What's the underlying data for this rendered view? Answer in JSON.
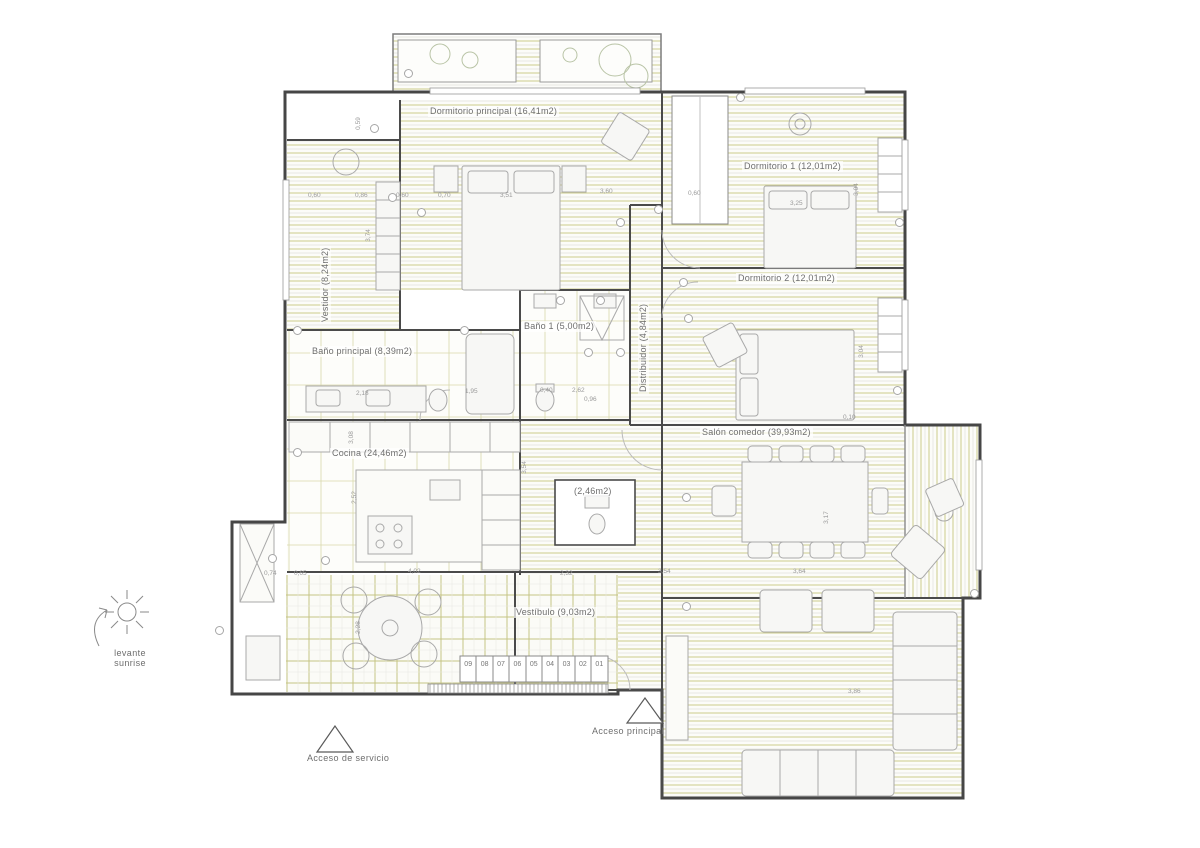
{
  "colors": {
    "hatch_olive": "#cdcc8b",
    "hatch_gray": "#e9e9e4",
    "tile_grid": "#c6c584",
    "wall": "#4a4a4a",
    "furniture": "#a9a9a9",
    "label_text": "#6e6e6e"
  },
  "rooms": {
    "dormitorio_principal": {
      "label": "Dormitorio principal (16,41m2)"
    },
    "dormitorio_1": {
      "label": "Dormitorio 1 (12,01m2)"
    },
    "dormitorio_2": {
      "label": "Dormitorio 2 (12,01m2)"
    },
    "vestidor": {
      "label": "Vestidor (8,24m2)"
    },
    "bano_principal": {
      "label": "Baño principal (8,39m2)"
    },
    "bano_1": {
      "label": "Baño 1 (5,00m2)"
    },
    "distribuidor": {
      "label": "Distribuidor (4,84m2)"
    },
    "cocina": {
      "label": "Cocina (24,46m2)"
    },
    "salon_comedor": {
      "label": "Salón comedor (39,93m2)"
    },
    "vestibulo": {
      "label": "Vestíbulo (9,03m2)"
    },
    "aseo": {
      "label": "(2,46m2)"
    }
  },
  "annotations": {
    "sun_line1": "levante",
    "sun_line2": "sunrise",
    "acceso_servicio": "Acceso de servicio",
    "acceso_principal": "Acceso principal"
  },
  "stairs": {
    "treads": [
      "09",
      "08",
      "07",
      "06",
      "05",
      "04",
      "03",
      "02",
      "01"
    ]
  },
  "dimensions": [
    {
      "text": "0,60",
      "x": 308,
      "y": 192
    },
    {
      "text": "0,86",
      "x": 355,
      "y": 192
    },
    {
      "text": "0,60",
      "x": 396,
      "y": 192
    },
    {
      "text": "0,70",
      "x": 438,
      "y": 192
    },
    {
      "text": "3,51",
      "x": 500,
      "y": 192
    },
    {
      "text": "3,60",
      "x": 600,
      "y": 188
    },
    {
      "text": "0,60",
      "x": 688,
      "y": 190
    },
    {
      "text": "3,25",
      "x": 790,
      "y": 200
    },
    {
      "text": "0,59",
      "x": 352,
      "y": 120,
      "r": -90
    },
    {
      "text": "3,74",
      "x": 362,
      "y": 232,
      "r": -90
    },
    {
      "text": "3,04",
      "x": 850,
      "y": 186,
      "r": -90
    },
    {
      "text": "3,04",
      "x": 855,
      "y": 348,
      "r": -90
    },
    {
      "text": "2,18",
      "x": 356,
      "y": 390
    },
    {
      "text": "1,95",
      "x": 465,
      "y": 388
    },
    {
      "text": "0,40",
      "x": 540,
      "y": 387
    },
    {
      "text": "2,62",
      "x": 572,
      "y": 387
    },
    {
      "text": "0,96",
      "x": 584,
      "y": 396
    },
    {
      "text": "0,10",
      "x": 843,
      "y": 414
    },
    {
      "text": "3,08",
      "x": 345,
      "y": 434,
      "r": -90
    },
    {
      "text": "2,52",
      "x": 348,
      "y": 494,
      "r": -90
    },
    {
      "text": "3,54",
      "x": 518,
      "y": 464,
      "r": -90
    },
    {
      "text": "3,17",
      "x": 820,
      "y": 514,
      "r": -90
    },
    {
      "text": "2,32",
      "x": 560,
      "y": 570
    },
    {
      "text": "3,54",
      "x": 658,
      "y": 568
    },
    {
      "text": "3,64",
      "x": 793,
      "y": 568
    },
    {
      "text": "0,74",
      "x": 264,
      "y": 570
    },
    {
      "text": "0,65",
      "x": 294,
      "y": 570
    },
    {
      "text": "4,02",
      "x": 408,
      "y": 568
    },
    {
      "text": "2,28",
      "x": 352,
      "y": 624,
      "r": -90
    },
    {
      "text": "3,86",
      "x": 848,
      "y": 688
    }
  ],
  "markers": [
    {
      "x": 404,
      "y": 69
    },
    {
      "x": 736,
      "y": 93
    },
    {
      "x": 370,
      "y": 124
    },
    {
      "x": 388,
      "y": 193
    },
    {
      "x": 417,
      "y": 208
    },
    {
      "x": 654,
      "y": 205
    },
    {
      "x": 616,
      "y": 218
    },
    {
      "x": 679,
      "y": 278
    },
    {
      "x": 684,
      "y": 314
    },
    {
      "x": 293,
      "y": 326
    },
    {
      "x": 460,
      "y": 326
    },
    {
      "x": 584,
      "y": 348
    },
    {
      "x": 616,
      "y": 348
    },
    {
      "x": 293,
      "y": 448
    },
    {
      "x": 682,
      "y": 493
    },
    {
      "x": 321,
      "y": 556
    },
    {
      "x": 268,
      "y": 554
    },
    {
      "x": 215,
      "y": 626
    },
    {
      "x": 682,
      "y": 602
    },
    {
      "x": 970,
      "y": 589
    },
    {
      "x": 895,
      "y": 218
    },
    {
      "x": 893,
      "y": 386
    },
    {
      "x": 556,
      "y": 296
    },
    {
      "x": 596,
      "y": 296
    }
  ]
}
